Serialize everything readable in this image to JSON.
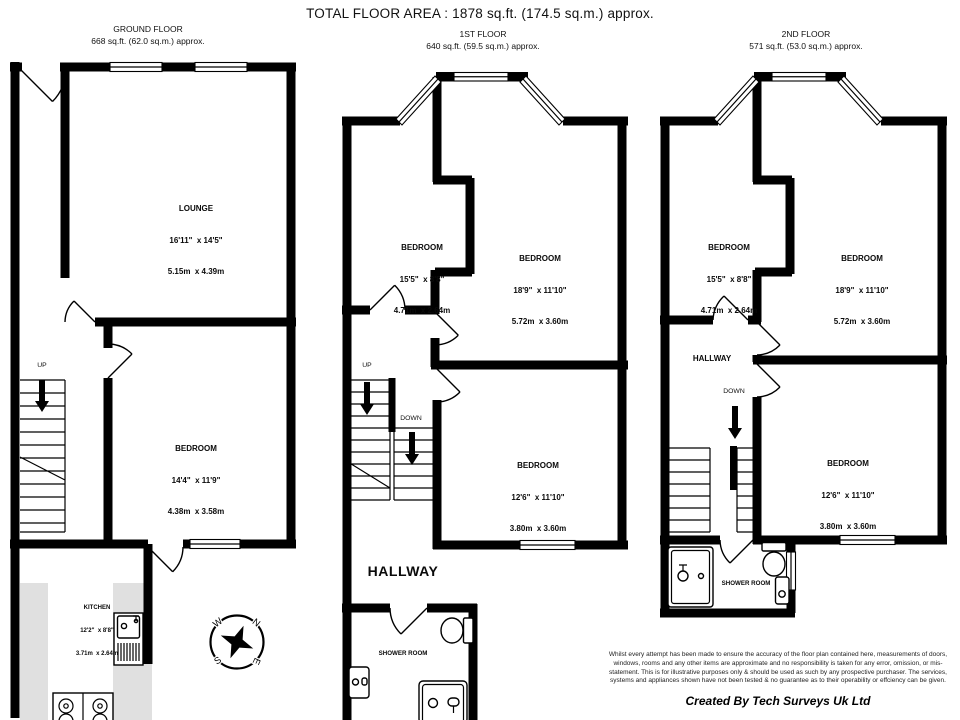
{
  "title": "TOTAL FLOOR AREA : 1878 sq.ft. (174.5 sq.m.) approx.",
  "ground_floor": {
    "name": "GROUND FLOOR",
    "area": "668 sq.ft. (62.0 sq.m.) approx.",
    "rooms": {
      "lounge": {
        "name": "LOUNGE",
        "imperial": "16'11\"  x 14'5\"",
        "metric": "5.15m  x 4.39m"
      },
      "bedroom": {
        "name": "BEDROOM",
        "imperial": "14'4\"  x 11'9\"",
        "metric": "4.38m  x 3.58m"
      },
      "kitchen": {
        "name": "KITCHEN",
        "imperial": "12'2\"  x 8'8\"",
        "metric": "3.71m  x 2.64m"
      }
    },
    "stairs": {
      "up": "UP"
    }
  },
  "first_floor": {
    "name": "1ST FLOOR",
    "area": "640 sq.ft. (59.5 sq.m.) approx.",
    "rooms": {
      "bedroom_front_left": {
        "name": "BEDROOM",
        "imperial": "15'5\"  x 8'8\"",
        "metric": "4.71m  x 2.64m"
      },
      "bedroom_front_right": {
        "name": "BEDROOM",
        "imperial": "18'9\"  x 11'10\"",
        "metric": "5.72m  x 3.60m"
      },
      "bedroom_back": {
        "name": "BEDROOM",
        "imperial": "12'6\"  x 11'10\"",
        "metric": "3.80m  x 3.60m"
      },
      "hallway": {
        "name": "HALLWAY"
      },
      "shower_room": {
        "name": "SHOWER ROOM"
      }
    },
    "stairs": {
      "up": "UP",
      "down": "DOWN"
    }
  },
  "second_floor": {
    "name": "2ND FLOOR",
    "area": "571 sq.ft. (53.0 sq.m.) approx.",
    "rooms": {
      "bedroom_front_left": {
        "name": "BEDROOM",
        "imperial": "15'5\"  x 8'8\"",
        "metric": "4.71m  x 2.64m"
      },
      "bedroom_front_right": {
        "name": "BEDROOM",
        "imperial": "18'9\"  x 11'10\"",
        "metric": "5.72m  x 3.60m"
      },
      "bedroom_back": {
        "name": "BEDROOM",
        "imperial": "12'6\"  x 11'10\"",
        "metric": "3.80m  x 3.60m"
      },
      "hallway": {
        "name": "HALLWAY"
      },
      "shower_room": {
        "name": "SHOWER ROOM"
      }
    },
    "stairs": {
      "down": "DOWN"
    }
  },
  "compass": {
    "n": "N",
    "e": "E",
    "s": "S",
    "w": "W"
  },
  "footer": {
    "disclaimer": "Whilst every attempt has been made to ensure the accuracy of the floor plan contained here, measurements of doors, windows, rooms and any other items are approximate and no responsibility is taken for any error, omission, or mis-statement. This is for illustrative purposes only & should be used as such by any prospective purchaser. The services, systems and appliances shown have not been tested & no guarantee as to their operability or effciency can be given.",
    "credit": "Created By Tech Surveys Uk Ltd"
  },
  "colors": {
    "wall": "#000000",
    "counter": "#e0e0e0",
    "background": "#ffffff"
  }
}
